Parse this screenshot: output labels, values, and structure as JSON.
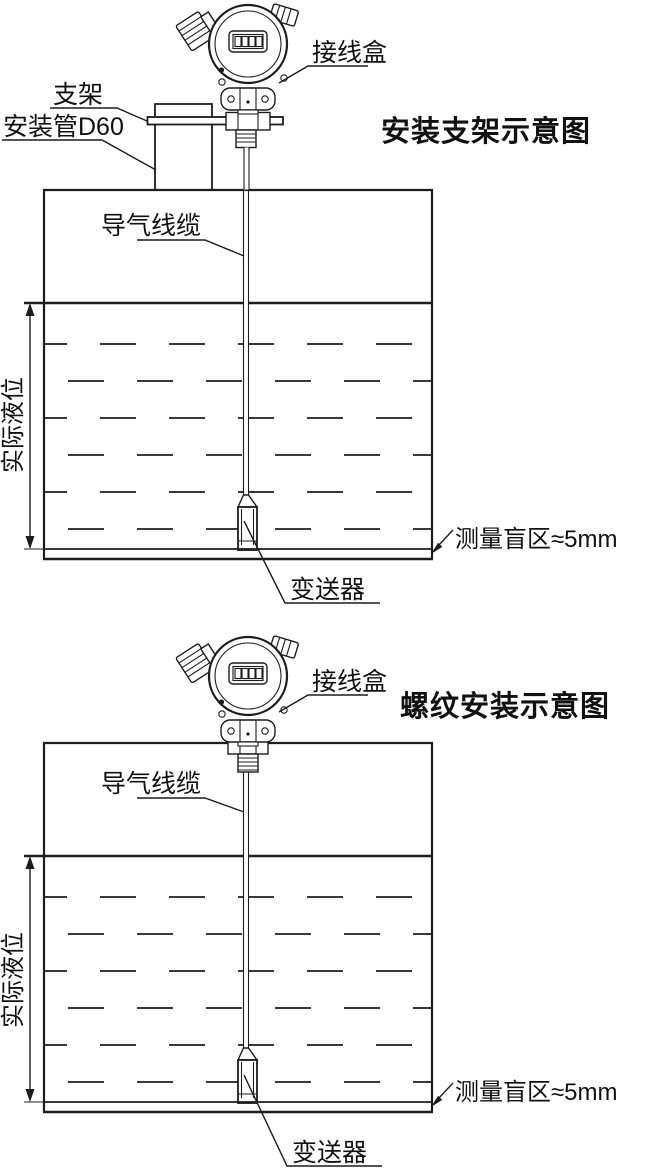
{
  "page": {
    "background": "#ffffff",
    "line_color": "#1c1c1c"
  },
  "top_diagram": {
    "title": "安装支架示意图",
    "labels": {
      "bracket": "支架",
      "mount_pipe": "安装管D60",
      "junction_box": "接线盒",
      "air_cable": "导气线缆",
      "actual_level": "实际液位",
      "transmitter": "变送器",
      "blind_zone": "测量盲区≈5mm"
    }
  },
  "bottom_diagram": {
    "title": "螺纹安装示意图",
    "labels": {
      "junction_box": "接线盒",
      "air_cable": "导气线缆",
      "actual_level": "实际液位",
      "transmitter": "变送器",
      "blind_zone": "测量盲区≈5mm"
    }
  }
}
